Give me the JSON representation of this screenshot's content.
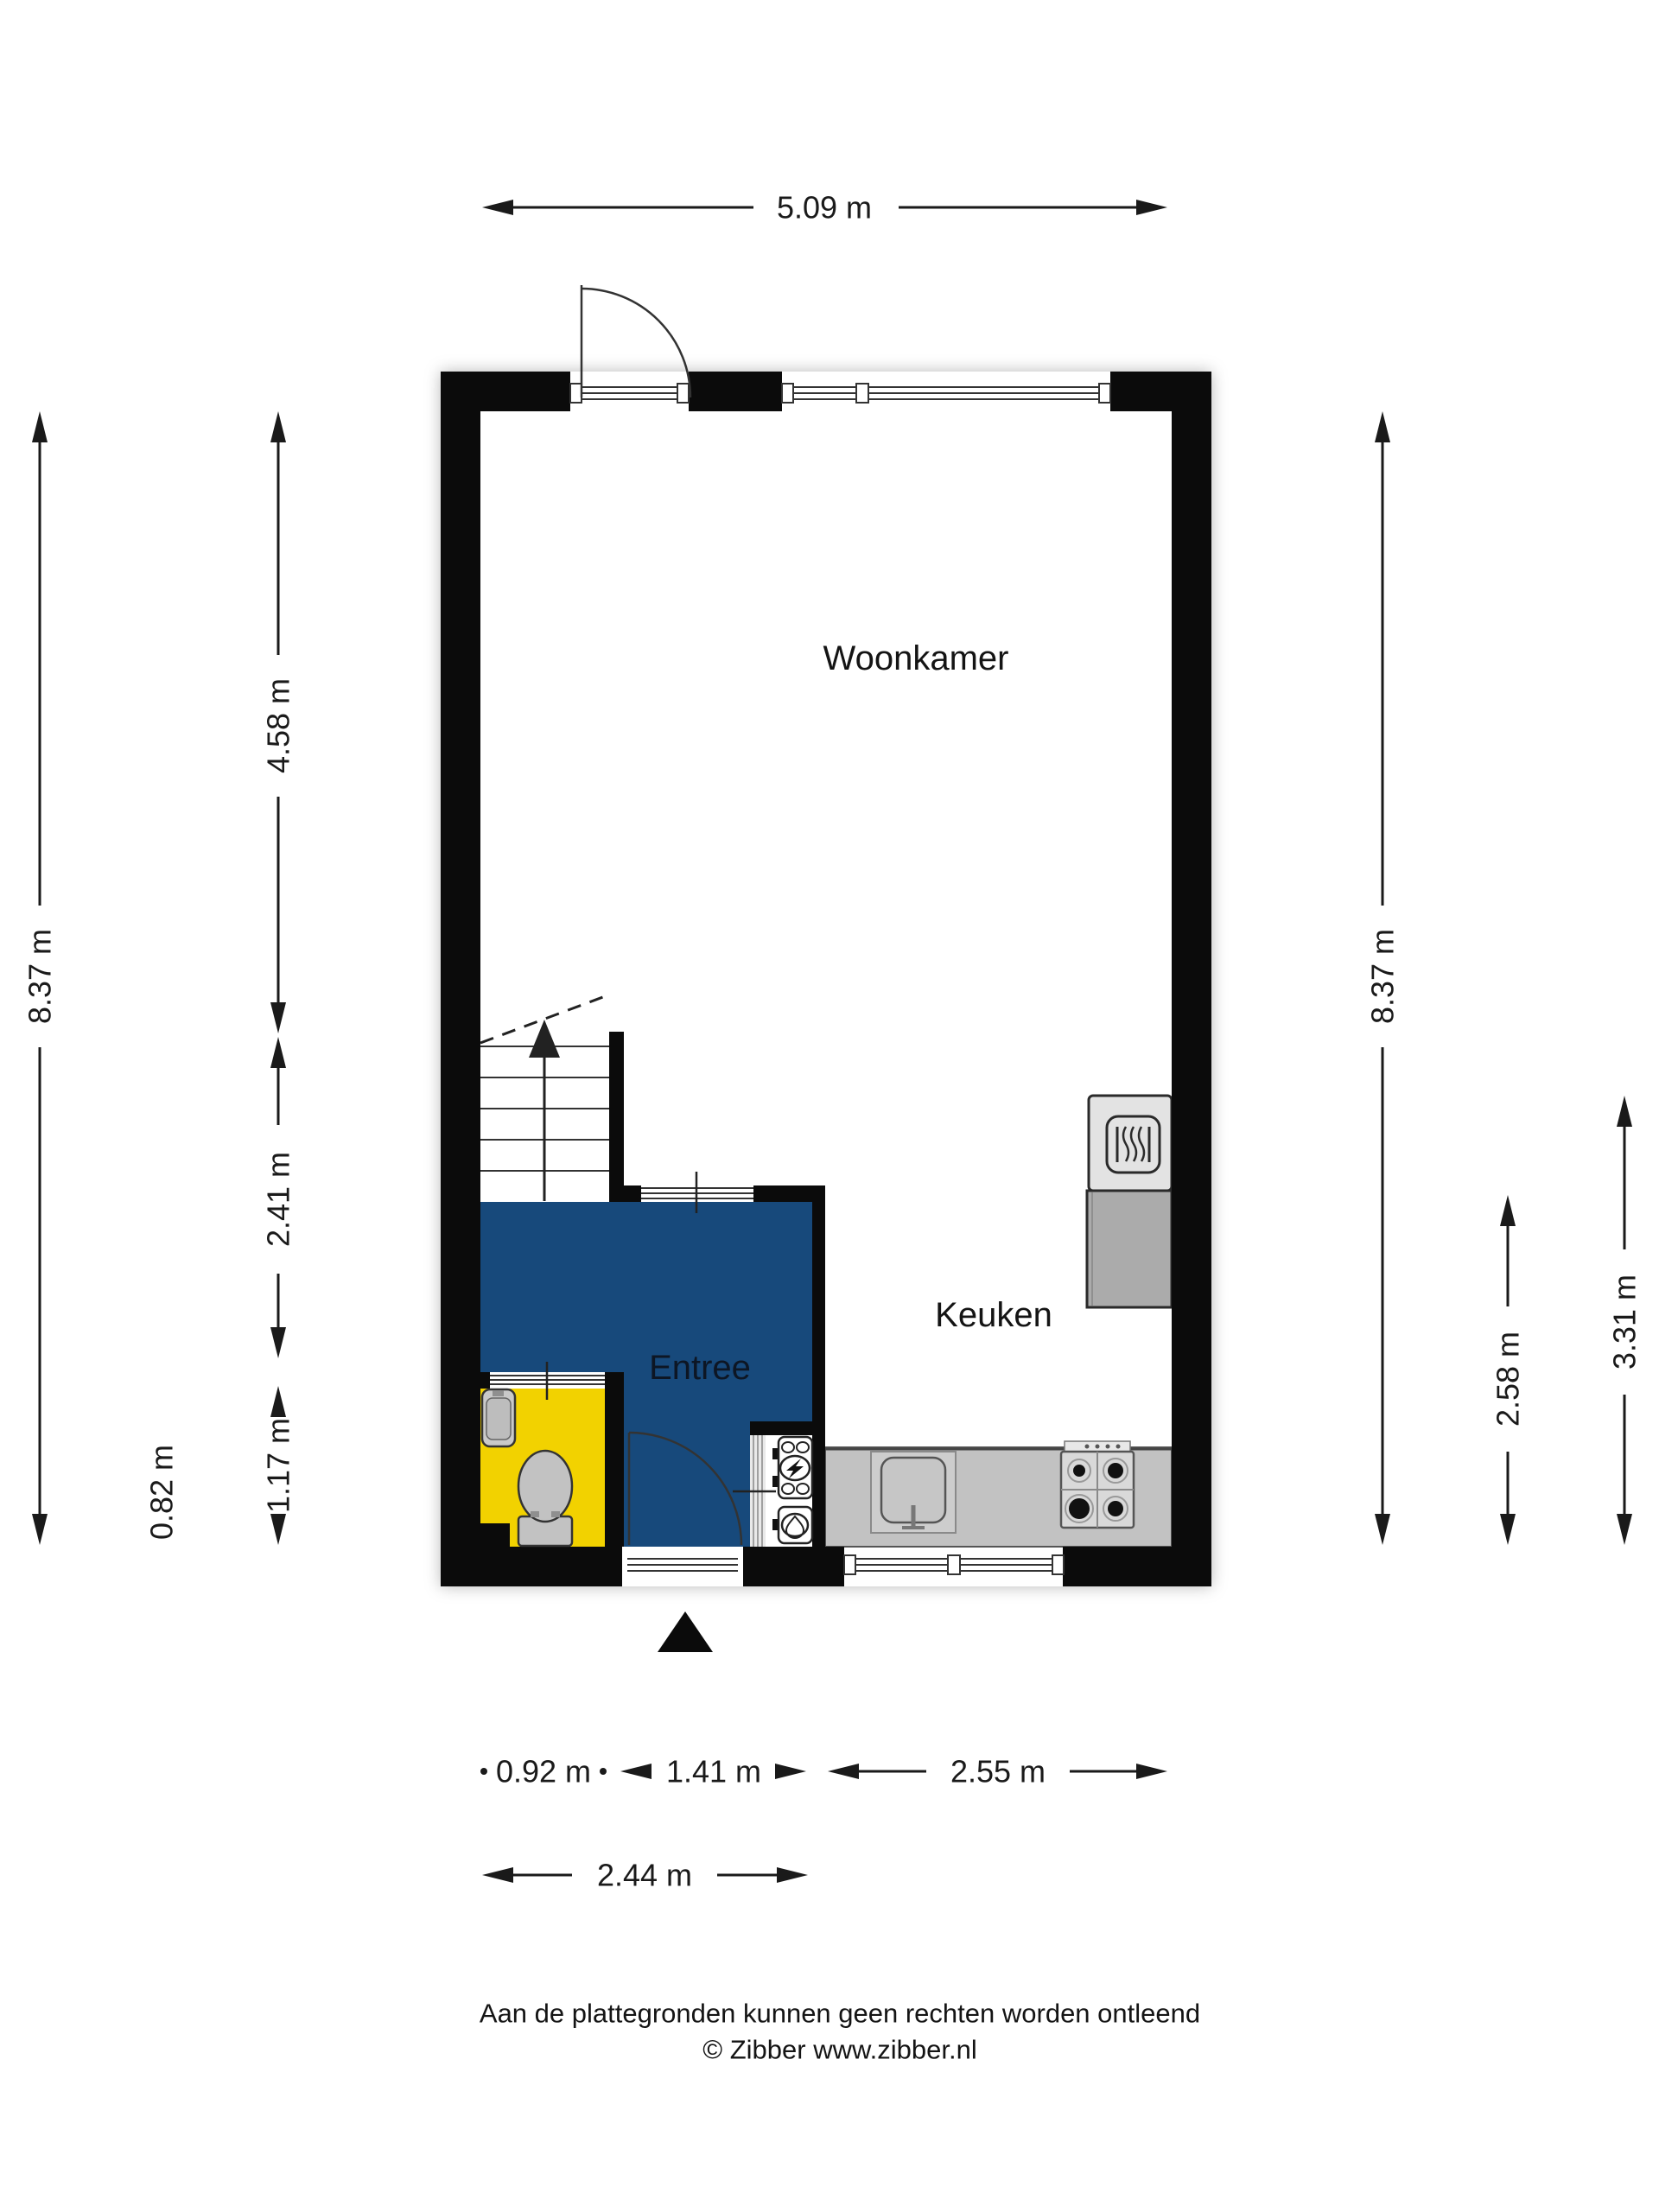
{
  "floorplan": {
    "rooms": {
      "living": "Woonkamer",
      "kitchen": "Keuken",
      "entry": "Entree"
    },
    "dimensions": {
      "top_width": "5.09 m",
      "left_total": "8.37 m",
      "left_upper": "4.58 m",
      "left_stairs": "2.41 m",
      "left_lower": "1.17 m",
      "left_offset": "0.82 m",
      "right_total": "8.37 m",
      "right_counter_span": "2.58 m",
      "right_kitchen_span": "3.31 m",
      "bottom_toilet": "0.92 m",
      "bottom_door": "1.41 m",
      "bottom_kitchen": "2.55 m",
      "bottom_entry_total": "2.44 m"
    },
    "colors": {
      "entry_floor": "#17497B",
      "toilet_floor": "#F2D200",
      "counter": "#C2C2C2",
      "wall": "#0B0B0B"
    },
    "footer": {
      "disclaimer": "Aan de plattegronden kunnen geen rechten worden ontleend",
      "credit": "© Zibber www.zibber.nl"
    }
  }
}
